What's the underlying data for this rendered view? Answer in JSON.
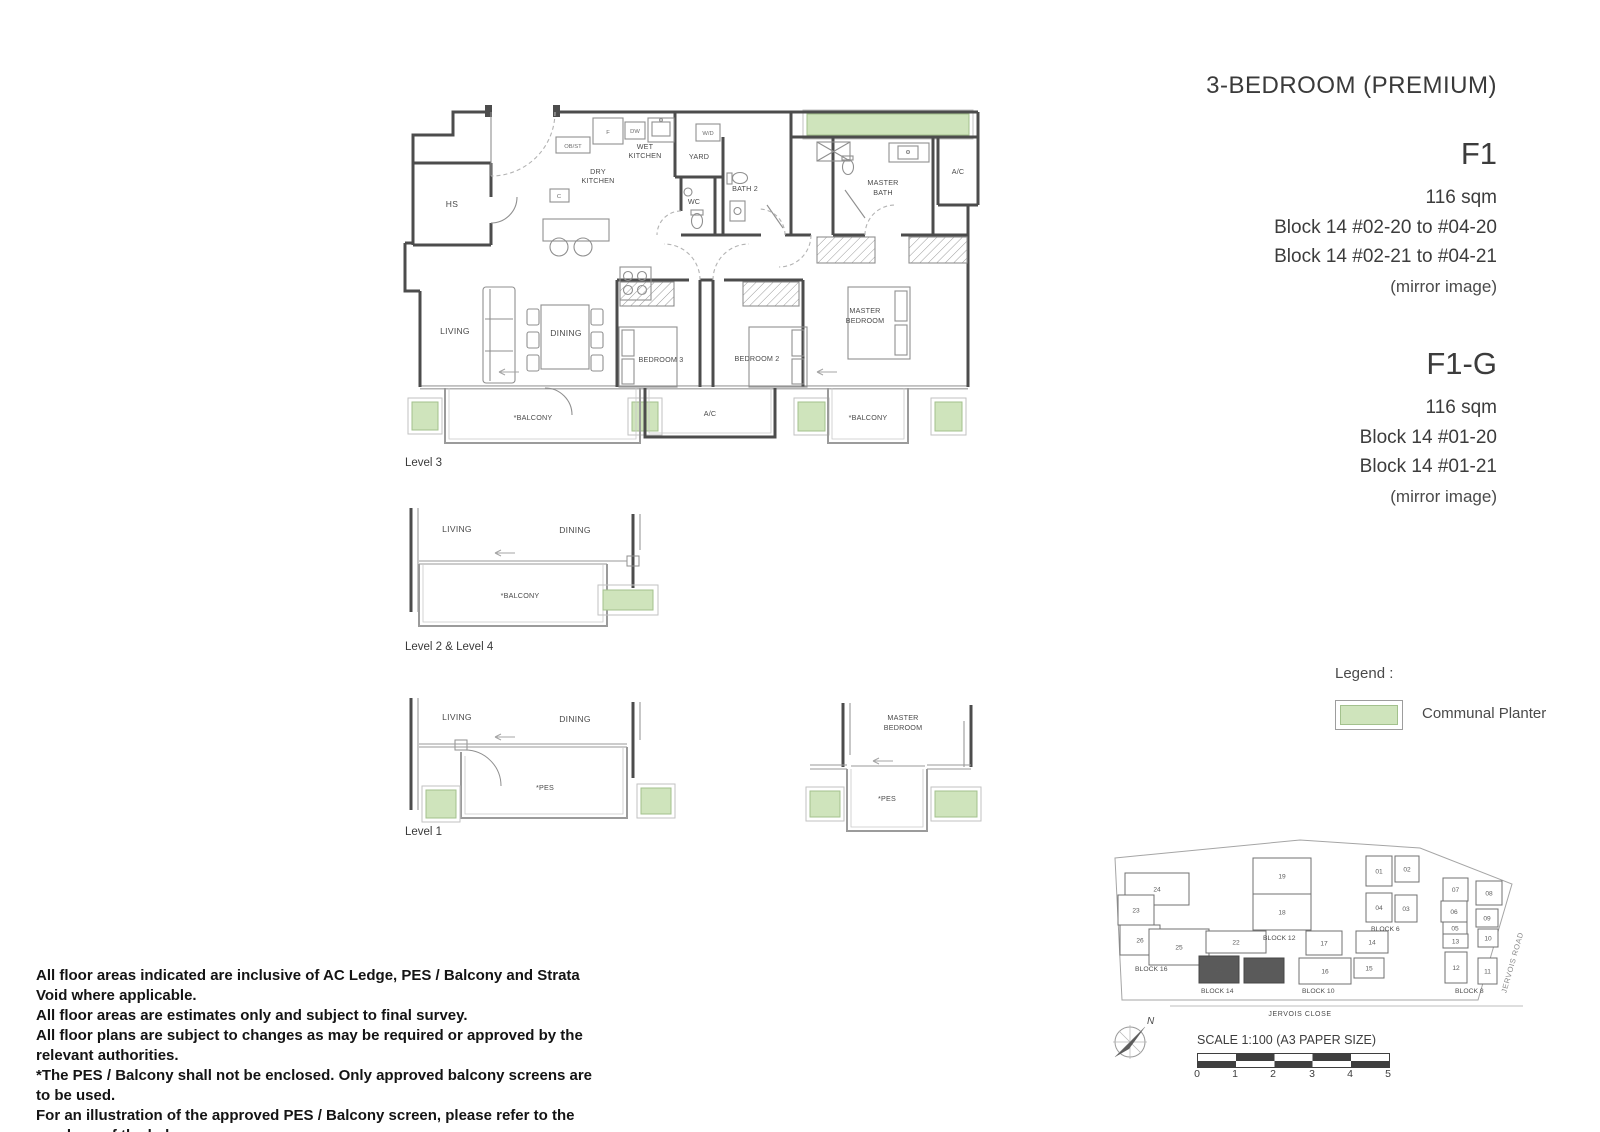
{
  "title": "3-BEDROOM (PREMIUM)",
  "units": {
    "f1": {
      "name": "F1",
      "area": "116 sqm",
      "line1": "Block 14  #02-20 to #04-20",
      "line2": "Block 14  #02-21 to #04-21",
      "note": "(mirror image)"
    },
    "f1g": {
      "name": "F1-G",
      "area": "116 sqm",
      "line1": "Block 14  #01-20",
      "line2": "Block 14  #01-21",
      "note": "(mirror image)"
    }
  },
  "plan": {
    "captions": {
      "l3": "Level 3",
      "l24": "Level 2  &  Level 4",
      "l1": "Level 1"
    },
    "rooms": {
      "hs": "HS",
      "living": "LIVING",
      "dining": "DINING",
      "dry1": "DRY",
      "dry2": "KITCHEN",
      "wet1": "WET",
      "wet2": "KITCHEN",
      "yard": "YARD",
      "wc": "WC",
      "bath2": "BATH 2",
      "master": "MASTER",
      "bath": "BATH",
      "bedroom": "BEDROOM",
      "ac": "A/C",
      "bedroom3": "BEDROOM 3",
      "bedroom2": "BEDROOM 2",
      "balcony": "*BALCONY",
      "pes": "*PES",
      "f": "F",
      "dw": "DW",
      "obst": "OB/ST",
      "wd": "W/D",
      "c": "C"
    }
  },
  "legend": {
    "title": "Legend :",
    "planter_label": "Communal Planter",
    "planter_fill": "#cfe4bc",
    "planter_border": "#a3c18d"
  },
  "site": {
    "nums": [
      "24",
      "23",
      "26",
      "25",
      "19",
      "18",
      "22",
      "21",
      "20",
      "17",
      "14",
      "16",
      "15",
      "01",
      "02",
      "04",
      "03",
      "07",
      "06",
      "05",
      "13",
      "12",
      "08",
      "09",
      "10",
      "11"
    ],
    "block_labels": [
      "BLOCK 16",
      "BLOCK 12",
      "BLOCK 14",
      "BLOCK 10",
      "BLOCK 6",
      "BLOCK 8"
    ],
    "roads": {
      "close": "JERVOIS CLOSE",
      "road": "JERVOIS ROAD"
    },
    "north": "N",
    "highlight_fill": "#5a5a5a"
  },
  "scalebar": {
    "label": "SCALE 1:100 (A3 PAPER SIZE)",
    "ticks": [
      "0",
      "1",
      "2",
      "3",
      "4",
      "5"
    ]
  },
  "disclaimer": {
    "lines": [
      "All floor areas indicated are inclusive of AC Ledge,  PES / Balcony and Strata Void where applicable.",
      "All floor areas are estimates only and subject to final survey.",
      "All floor plans are subject to changes as may be required or approved by the relevant authorities.",
      "*The PES / Balcony shall not be enclosed. Only approved balcony screens are to be used.",
      "For an illustration of the approved PES / Balcony screen, please refer to the mock-up of the balcony",
      "screen at Type D2 show unit."
    ]
  }
}
